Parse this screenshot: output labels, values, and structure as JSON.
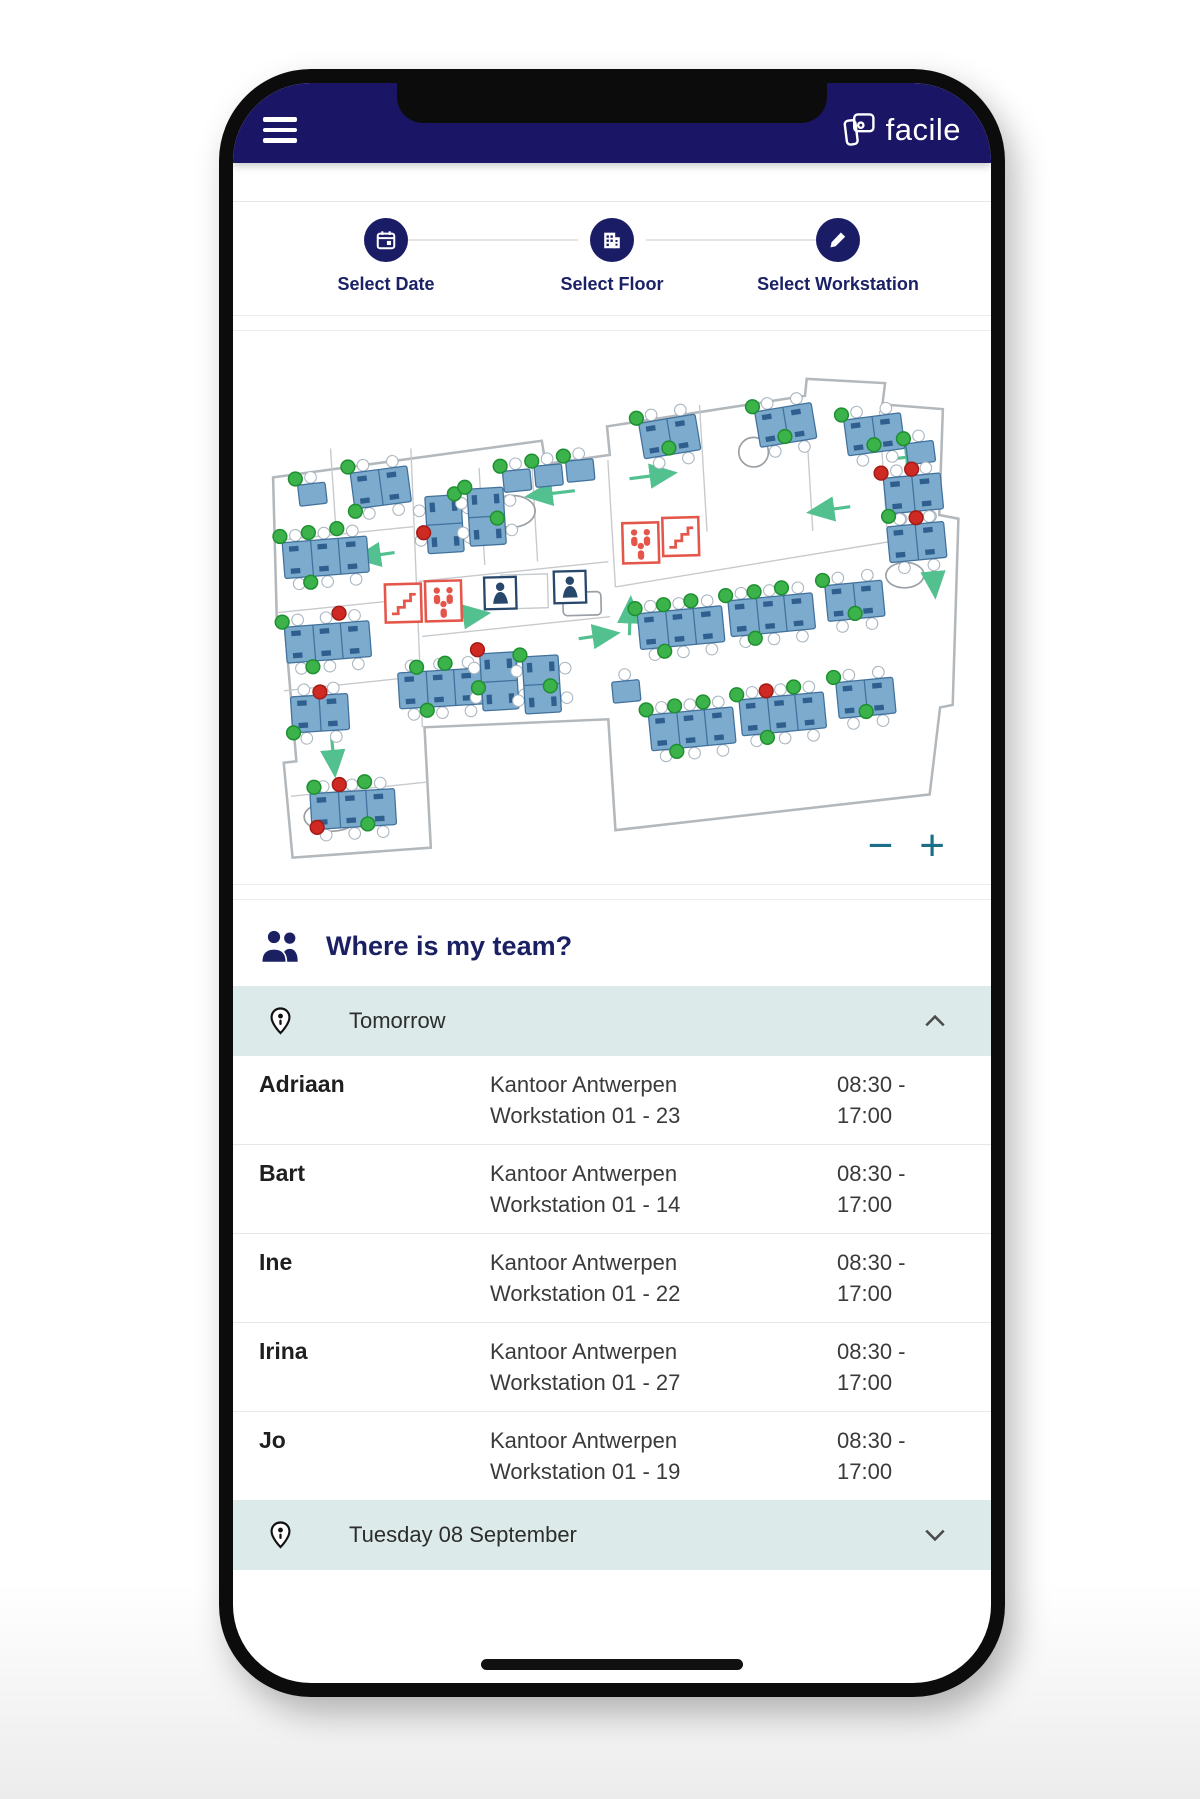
{
  "header": {
    "brand": "facile"
  },
  "stepper": {
    "steps": [
      {
        "label": "Select Date",
        "icon": "calendar-icon"
      },
      {
        "label": "Select Floor",
        "icon": "floor-icon"
      },
      {
        "label": "Select Workstation",
        "icon": "pencil-icon"
      }
    ]
  },
  "map": {
    "zoom_out_label": "−",
    "zoom_in_label": "+",
    "colors": {
      "available_dot": "#3bb24a",
      "occupied_dot": "#ce2922",
      "desk_fill": "#7cabce",
      "arrow": "#52c08f",
      "alert_red": "#e4564a",
      "wall_gray": "#b3b8bc"
    }
  },
  "team": {
    "title": "Where is my team?"
  },
  "accordions": [
    {
      "label": "Tomorrow",
      "chevron": "up"
    },
    {
      "label": "Tuesday 08 September",
      "chevron": "down"
    }
  ],
  "rows": [
    {
      "name": "Adriaan",
      "location": "Kantoor Antwerpen",
      "workstation": "Workstation 01 - 23",
      "time_start": "08:30 -",
      "time_end": "17:00"
    },
    {
      "name": "Bart",
      "location": "Kantoor Antwerpen",
      "workstation": "Workstation 01 - 14",
      "time_start": "08:30 -",
      "time_end": "17:00"
    },
    {
      "name": "Ine",
      "location": "Kantoor Antwerpen",
      "workstation": "Workstation 01 - 22",
      "time_start": "08:30 -",
      "time_end": "17:00"
    },
    {
      "name": "Irina",
      "location": "Kantoor Antwerpen",
      "workstation": "Workstation 01 - 27",
      "time_start": "08:30 -",
      "time_end": "17:00"
    },
    {
      "name": "Jo",
      "location": "Kantoor Antwerpen",
      "workstation": "Workstation 01 - 19",
      "time_start": "08:30 -",
      "time_end": "17:00"
    }
  ]
}
